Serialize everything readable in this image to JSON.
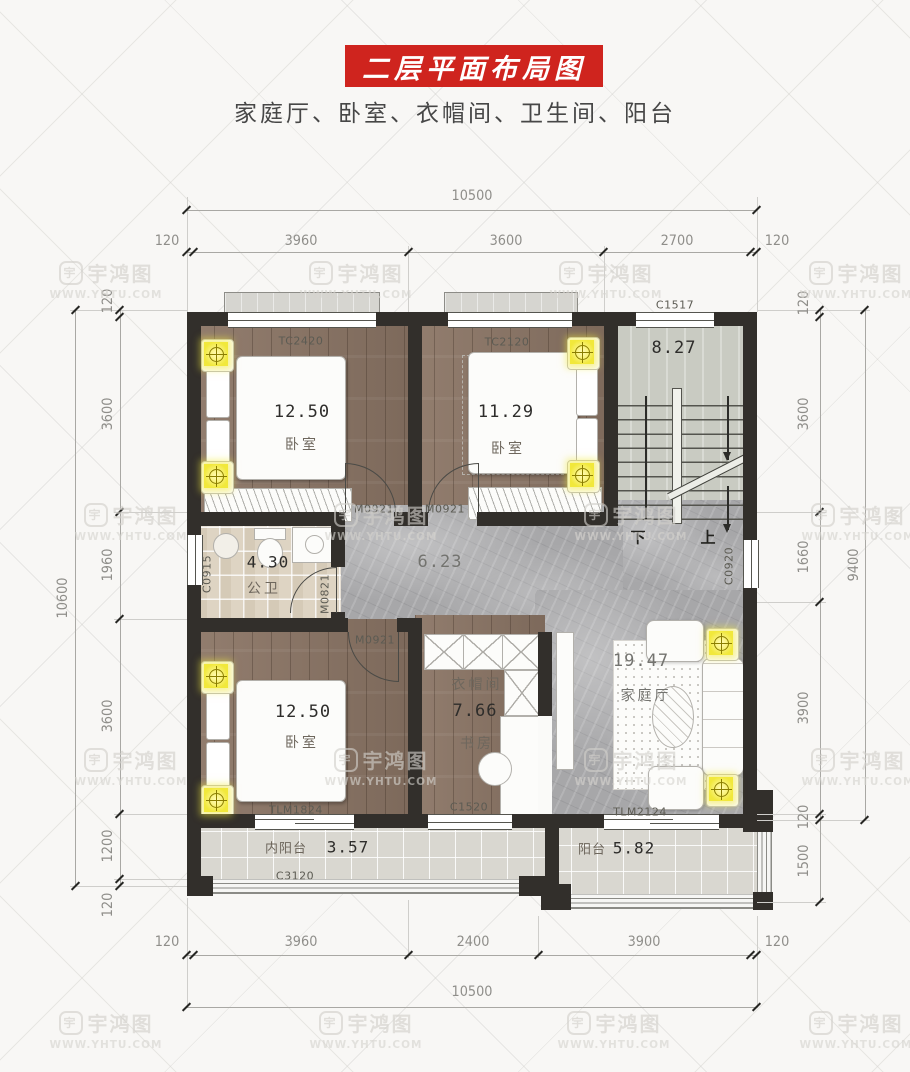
{
  "page": {
    "title": "二层平面布局图",
    "subtitle": "家庭厅、卧室、衣帽间、卫生间、阳台"
  },
  "watermark": {
    "brand": "宇鸿图",
    "url": "WWW.YHTU.COM",
    "logo_char": "宇",
    "positions": [
      [
        40,
        258
      ],
      [
        290,
        258
      ],
      [
        540,
        258
      ],
      [
        790,
        258
      ],
      [
        65,
        500
      ],
      [
        315,
        500
      ],
      [
        565,
        500
      ],
      [
        792,
        500
      ],
      [
        65,
        745
      ],
      [
        315,
        745
      ],
      [
        565,
        745
      ],
      [
        792,
        745
      ],
      [
        40,
        1008
      ],
      [
        300,
        1008
      ],
      [
        548,
        1008
      ],
      [
        790,
        1008
      ]
    ]
  },
  "colors": {
    "accent_red": "#cf241e",
    "wall": "#322f2b",
    "wood_floor": "#8b7565",
    "marble_floor": "#a7a7a9",
    "bath_tile": "#ded4c3",
    "balcony_tile": "#d9d7d0",
    "stair_floor": "#c9cbc2",
    "light_yellow": "#f1e83b"
  },
  "dims": {
    "top": {
      "overall": "10500",
      "segments": [
        "120",
        "3960",
        "3600",
        "2700",
        "120"
      ]
    },
    "bottom": {
      "overall": "10500",
      "segments": [
        "120",
        "3960",
        "2400",
        "3900",
        "120"
      ]
    },
    "left": {
      "overall": "10600",
      "segments": [
        "120",
        "3600",
        "1960",
        "3600",
        "1200",
        "120"
      ]
    },
    "right": {
      "overall": "9400",
      "segments": [
        "120",
        "3600",
        "1660",
        "3900",
        "120",
        "1500"
      ]
    }
  },
  "rooms": {
    "bedroom_tl": {
      "name": "卧室",
      "area": "12.50"
    },
    "bedroom_tr": {
      "name": "卧室",
      "area": "11.29"
    },
    "stairs": {
      "area": "8.27",
      "down": "下",
      "up": "上"
    },
    "bathroom": {
      "name": "公卫",
      "area": "4.30"
    },
    "hall": {
      "area": "6.23"
    },
    "bedroom_bl": {
      "name": "卧室",
      "area": "12.50"
    },
    "cloakroom": {
      "name": "衣帽间",
      "area": "7.66",
      "sub": "书房"
    },
    "family_hall": {
      "name": "家庭厅",
      "area": "19.47"
    },
    "inner_balcony": {
      "name": "内阳台",
      "area": "3.57"
    },
    "balcony": {
      "name": "阳台",
      "area": "5.82"
    }
  },
  "openings": {
    "tc2420": "TC2420",
    "tc2120": "TC2120",
    "c1517": "C1517",
    "m0921": "M0921",
    "c0915": "C0915",
    "m0821": "M0821",
    "c0920": "C0920",
    "tlm1824": "TLM1824",
    "c1520": "C1520",
    "tlm2124": "TLM2124",
    "c3120": "C3120"
  }
}
